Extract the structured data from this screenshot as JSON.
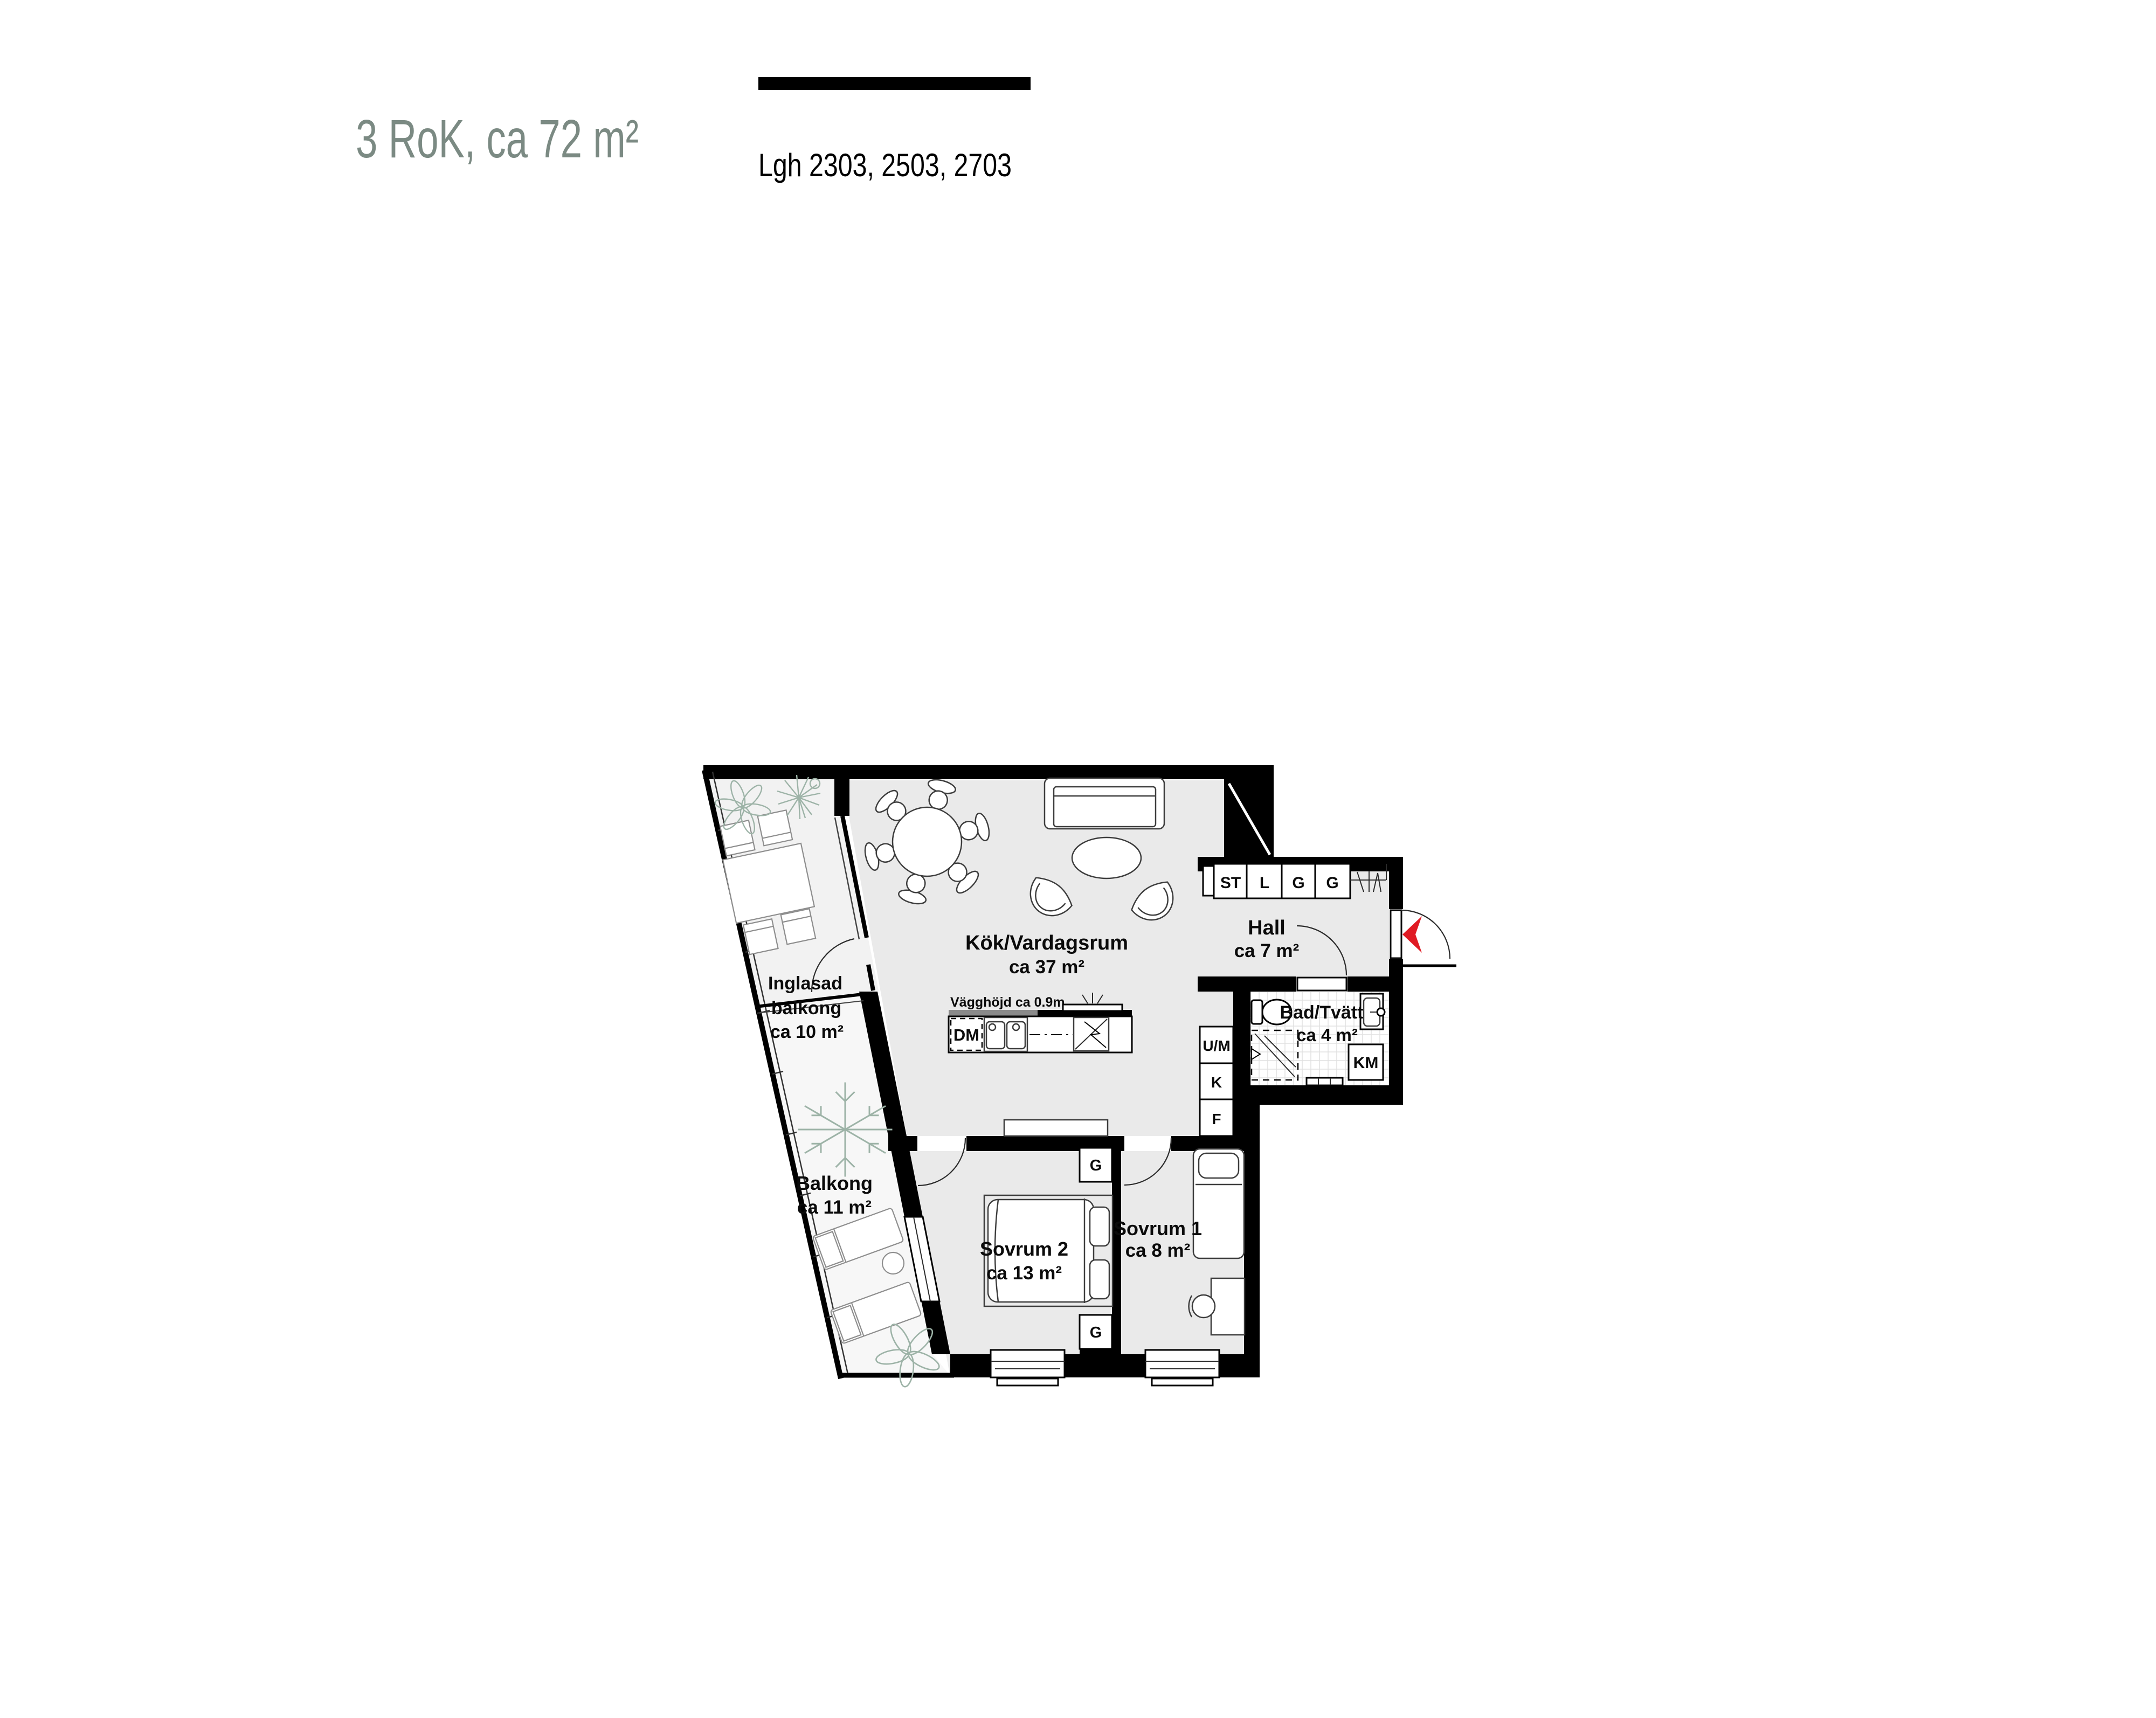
{
  "header": {
    "title": "3 RoK, ca 72 m²",
    "units_label": "Lgh 2303, 2503, 2703"
  },
  "plan": {
    "rooms": {
      "kitchen_living": {
        "name": "Kök/Vardagsrum",
        "area": "ca 37 m²"
      },
      "hall": {
        "name": "Hall",
        "area": "ca 7 m²"
      },
      "bath": {
        "name": "Bad/Tvätt",
        "area": "ca 4 m²"
      },
      "bedroom2": {
        "name": "Sovrum 2",
        "area": "ca 13 m²"
      },
      "bedroom1": {
        "name": "Sovrum 1",
        "area": "ca 8 m²"
      },
      "glazed_balcony": {
        "name_line1": "Inglasad",
        "name_line2": "balkong",
        "area": "ca 10 m²"
      },
      "balcony": {
        "name": "Balkong",
        "area": "ca 11 m²"
      }
    },
    "fixtures": {
      "wardrobe_row": [
        "ST",
        "L",
        "G",
        "G"
      ],
      "appliance_column": [
        "U/M",
        "K",
        "F"
      ],
      "dishwasher": "DM",
      "washing_machine": "KM",
      "bedroom_wardrobes": [
        "G",
        "G"
      ],
      "wall_height_note": "Vägghöjd ca 0.9m"
    },
    "colors": {
      "wall": "#000000",
      "floor": "#eaeaea",
      "glazed_balcony_floor": "#f2f2f2",
      "balcony_floor": "#f7f7f7",
      "title": "#7b8a83",
      "entry_arrow": "#e01b24",
      "plant": "#9db3a7",
      "counter_gray": "#8a8a8a"
    }
  }
}
